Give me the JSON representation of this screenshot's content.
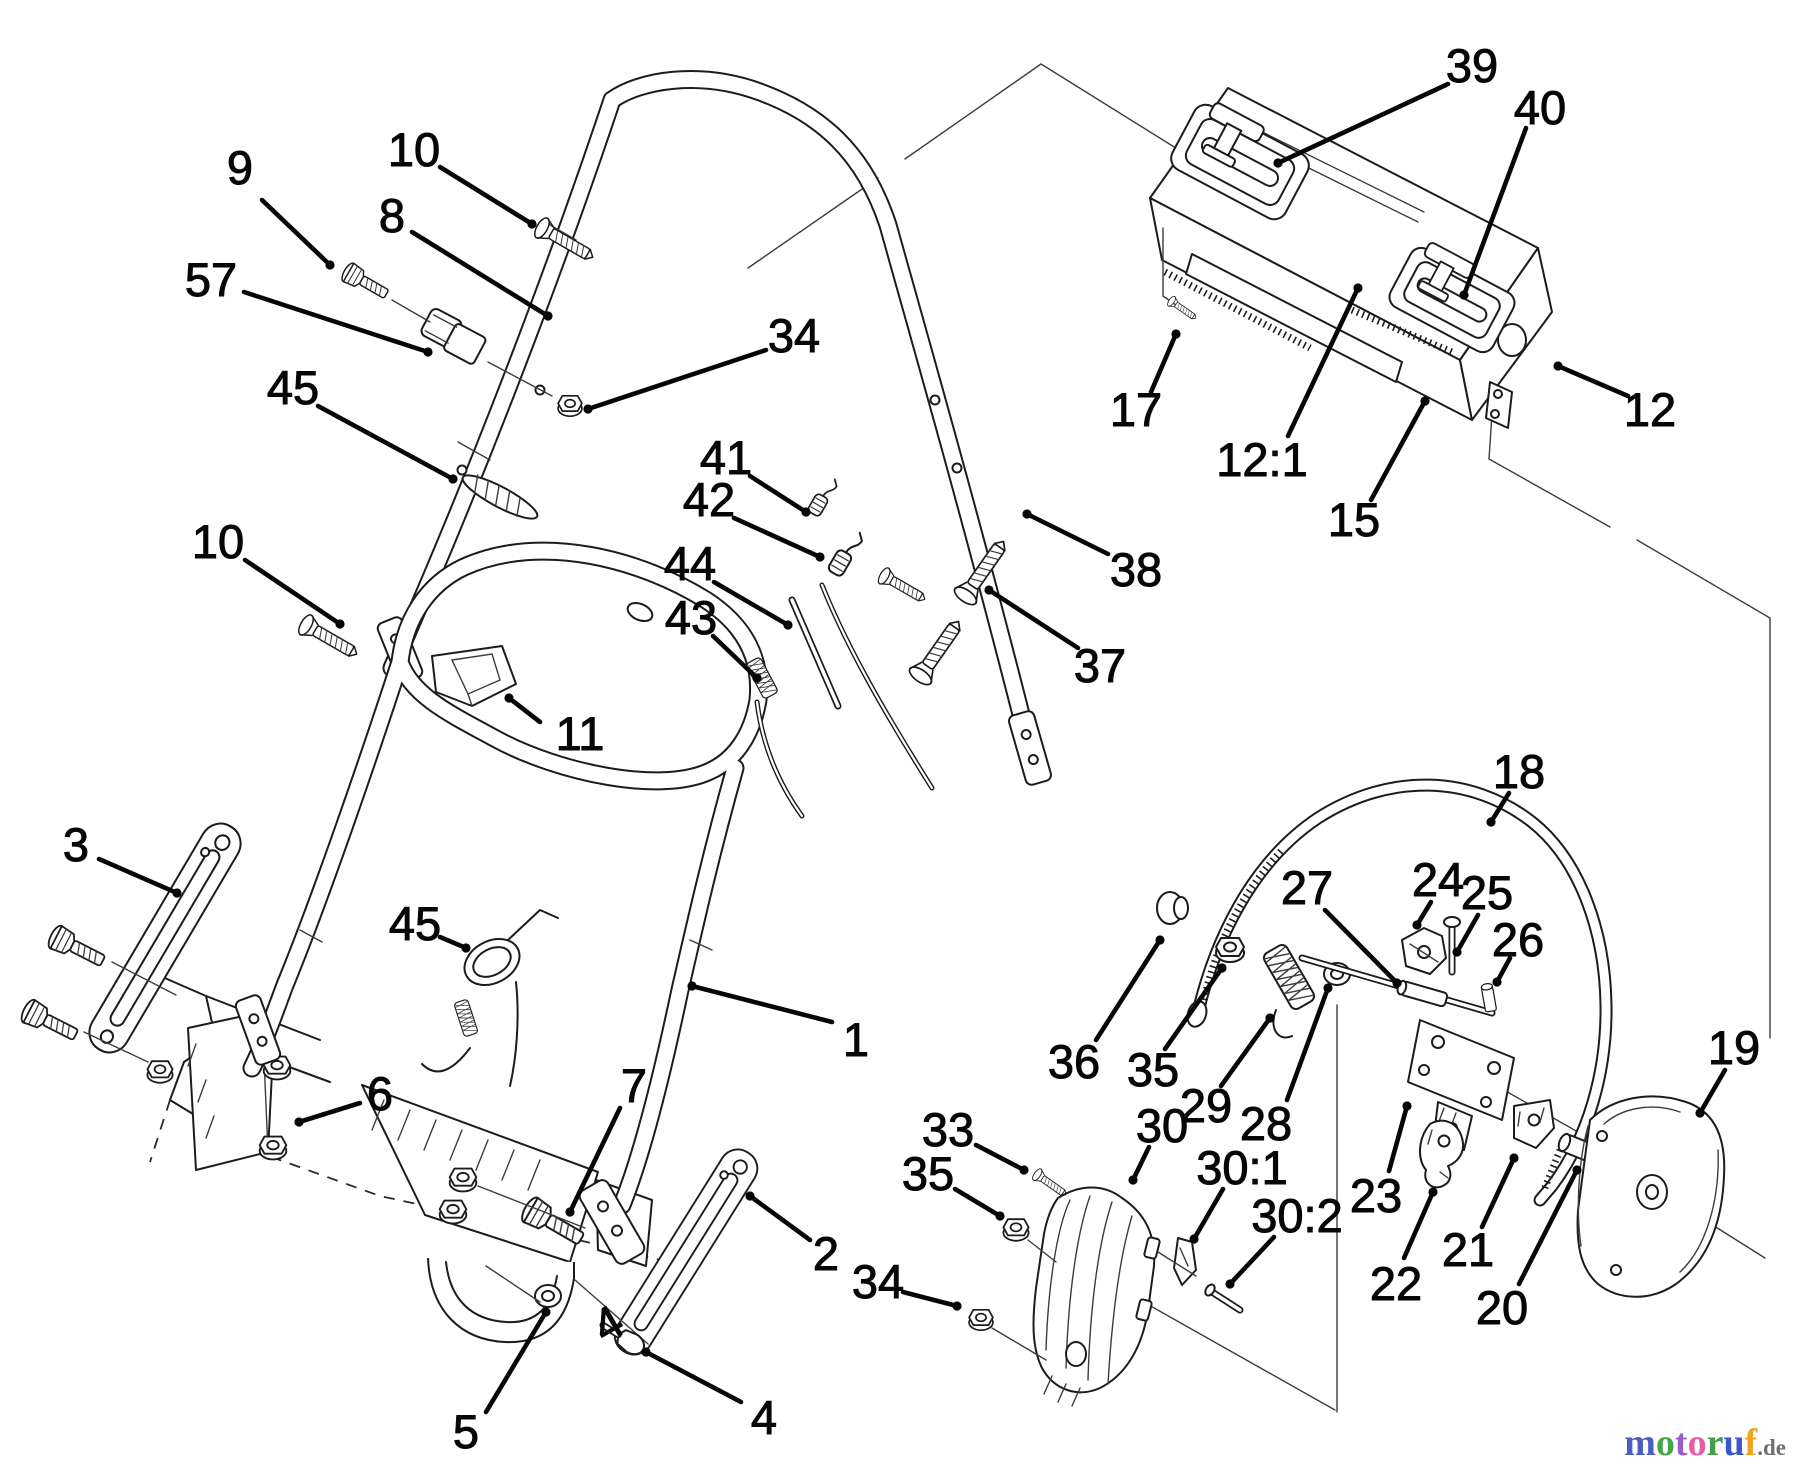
{
  "canvas": {
    "width": 1800,
    "height": 1470,
    "background": "#ffffff",
    "line_color": "#1c1c1c"
  },
  "diagram": {
    "type": "exploded-parts-diagram",
    "subject": "lawn mower handle assembly",
    "label_color": "#060606"
  },
  "labels": [
    {
      "text": "9",
      "x": 240,
      "y": 168,
      "leader": [
        262,
        200,
        330,
        265
      ]
    },
    {
      "text": "10",
      "x": 414,
      "y": 150,
      "leader": [
        440,
        167,
        532,
        224
      ]
    },
    {
      "text": "8",
      "x": 392,
      "y": 216,
      "leader": [
        412,
        232,
        548,
        316
      ]
    },
    {
      "text": "57",
      "x": 211,
      "y": 280,
      "leader": [
        244,
        292,
        428,
        352
      ]
    },
    {
      "text": "34",
      "x": 794,
      "y": 336,
      "leader": [
        766,
        350,
        588,
        409
      ]
    },
    {
      "text": "45",
      "x": 293,
      "y": 388,
      "leader": [
        318,
        406,
        453,
        479
      ]
    },
    {
      "text": "10",
      "x": 218,
      "y": 542,
      "leader": [
        245,
        560,
        340,
        624
      ]
    },
    {
      "text": "11",
      "x": 580,
      "y": 734,
      "leader": [
        540,
        722,
        509,
        698
      ]
    },
    {
      "text": "41",
      "x": 726,
      "y": 458,
      "leader": [
        750,
        476,
        806,
        512
      ]
    },
    {
      "text": "42",
      "x": 709,
      "y": 500,
      "leader": [
        734,
        518,
        820,
        557
      ]
    },
    {
      "text": "44",
      "x": 690,
      "y": 564,
      "leader": [
        714,
        582,
        788,
        625
      ]
    },
    {
      "text": "43",
      "x": 691,
      "y": 618,
      "leader": [
        713,
        636,
        757,
        678
      ]
    },
    {
      "text": "39",
      "x": 1472,
      "y": 66,
      "leader": [
        1448,
        84,
        1278,
        163
      ]
    },
    {
      "text": "40",
      "x": 1540,
      "y": 108,
      "leader": [
        1526,
        128,
        1464,
        295
      ]
    },
    {
      "text": "17",
      "x": 1136,
      "y": 410,
      "leader": [
        1151,
        392,
        1176,
        334
      ]
    },
    {
      "text": "12:1",
      "x": 1262,
      "y": 460,
      "leader": [
        1288,
        436,
        1358,
        288
      ]
    },
    {
      "text": "15",
      "x": 1354,
      "y": 520,
      "leader": [
        1371,
        500,
        1425,
        401
      ]
    },
    {
      "text": "12",
      "x": 1650,
      "y": 410,
      "leader": [
        1628,
        396,
        1558,
        366
      ]
    },
    {
      "text": "38",
      "x": 1136,
      "y": 570,
      "leader": [
        1108,
        554,
        1027,
        514
      ]
    },
    {
      "text": "37",
      "x": 1100,
      "y": 666,
      "leader": [
        1078,
        648,
        989,
        590
      ]
    },
    {
      "text": "3",
      "x": 76,
      "y": 845,
      "leader": [
        99,
        859,
        177,
        893
      ]
    },
    {
      "text": "45",
      "x": 415,
      "y": 924,
      "leader": [
        440,
        937,
        466,
        948
      ]
    },
    {
      "text": "6",
      "x": 380,
      "y": 1094,
      "leader": [
        360,
        1103,
        299,
        1122
      ]
    },
    {
      "text": "1",
      "x": 856,
      "y": 1040,
      "leader": [
        832,
        1022,
        692,
        986
      ]
    },
    {
      "text": "7",
      "x": 634,
      "y": 1086,
      "leader": [
        620,
        1108,
        570,
        1212
      ]
    },
    {
      "text": "2",
      "x": 826,
      "y": 1254,
      "leader": [
        810,
        1240,
        750,
        1196
      ]
    },
    {
      "text": "5",
      "x": 466,
      "y": 1432,
      "leader": [
        486,
        1412,
        546,
        1312
      ]
    },
    {
      "text": "4",
      "x": 764,
      "y": 1418,
      "leader": [
        741,
        1402,
        646,
        1352
      ]
    },
    {
      "text": "4",
      "x": 608,
      "y": 1324,
      "rot": -30
    },
    {
      "text": "34",
      "x": 878,
      "y": 1282,
      "leader": [
        903,
        1292,
        957,
        1306
      ]
    },
    {
      "text": "18",
      "x": 1519,
      "y": 772,
      "leader": [
        1509,
        793,
        1491,
        822
      ]
    },
    {
      "text": "27",
      "x": 1307,
      "y": 888,
      "leader": [
        1325,
        910,
        1397,
        983
      ]
    },
    {
      "text": "24",
      "x": 1438,
      "y": 880,
      "leader": [
        1431,
        902,
        1417,
        925
      ]
    },
    {
      "text": "25",
      "x": 1487,
      "y": 893,
      "leader": [
        1478,
        915,
        1457,
        952
      ]
    },
    {
      "text": "26",
      "x": 1518,
      "y": 940,
      "leader": [
        1510,
        958,
        1497,
        982
      ]
    },
    {
      "text": "36",
      "x": 1074,
      "y": 1062,
      "leader": [
        1096,
        1040,
        1160,
        940
      ]
    },
    {
      "text": "35",
      "x": 1153,
      "y": 1070,
      "leader": [
        1165,
        1049,
        1222,
        968
      ]
    },
    {
      "text": "29",
      "x": 1206,
      "y": 1106,
      "leader": [
        1221,
        1086,
        1270,
        1018
      ]
    },
    {
      "text": "28",
      "x": 1266,
      "y": 1124,
      "leader": [
        1287,
        1100,
        1328,
        988
      ]
    },
    {
      "text": "33",
      "x": 948,
      "y": 1130,
      "leader": [
        976,
        1145,
        1024,
        1170
      ]
    },
    {
      "text": "35",
      "x": 928,
      "y": 1174,
      "leader": [
        955,
        1189,
        1000,
        1216
      ]
    },
    {
      "text": "30",
      "x": 1162,
      "y": 1126,
      "leader": [
        1149,
        1147,
        1133,
        1180
      ]
    },
    {
      "text": "30:1",
      "x": 1242,
      "y": 1168,
      "leader": [
        1223,
        1189,
        1194,
        1239
      ]
    },
    {
      "text": "30:2",
      "x": 1297,
      "y": 1216,
      "leader": [
        1274,
        1237,
        1230,
        1284
      ]
    },
    {
      "text": "23",
      "x": 1376,
      "y": 1196,
      "leader": [
        1389,
        1171,
        1407,
        1106
      ]
    },
    {
      "text": "22",
      "x": 1396,
      "y": 1284,
      "leader": [
        1404,
        1258,
        1433,
        1192
      ]
    },
    {
      "text": "21",
      "x": 1468,
      "y": 1250,
      "leader": [
        1482,
        1227,
        1514,
        1158
      ]
    },
    {
      "text": "20",
      "x": 1502,
      "y": 1308,
      "leader": [
        1519,
        1284,
        1577,
        1170
      ]
    },
    {
      "text": "19",
      "x": 1734,
      "y": 1048,
      "leader": [
        1725,
        1070,
        1700,
        1113
      ]
    }
  ],
  "watermark": {
    "letters": [
      {
        "ch": "m",
        "color": "#4a5fc0"
      },
      {
        "ch": "o",
        "color": "#45a64d"
      },
      {
        "ch": "t",
        "color": "#9a5fc4"
      },
      {
        "ch": "o",
        "color": "#e85aa5"
      },
      {
        "ch": "r",
        "color": "#3f9e49"
      },
      {
        "ch": "u",
        "color": "#3b55cb"
      },
      {
        "ch": "f",
        "color": "#f0a41c"
      }
    ],
    "suffix": ".de",
    "suffix_color": "#6f6f6f"
  }
}
